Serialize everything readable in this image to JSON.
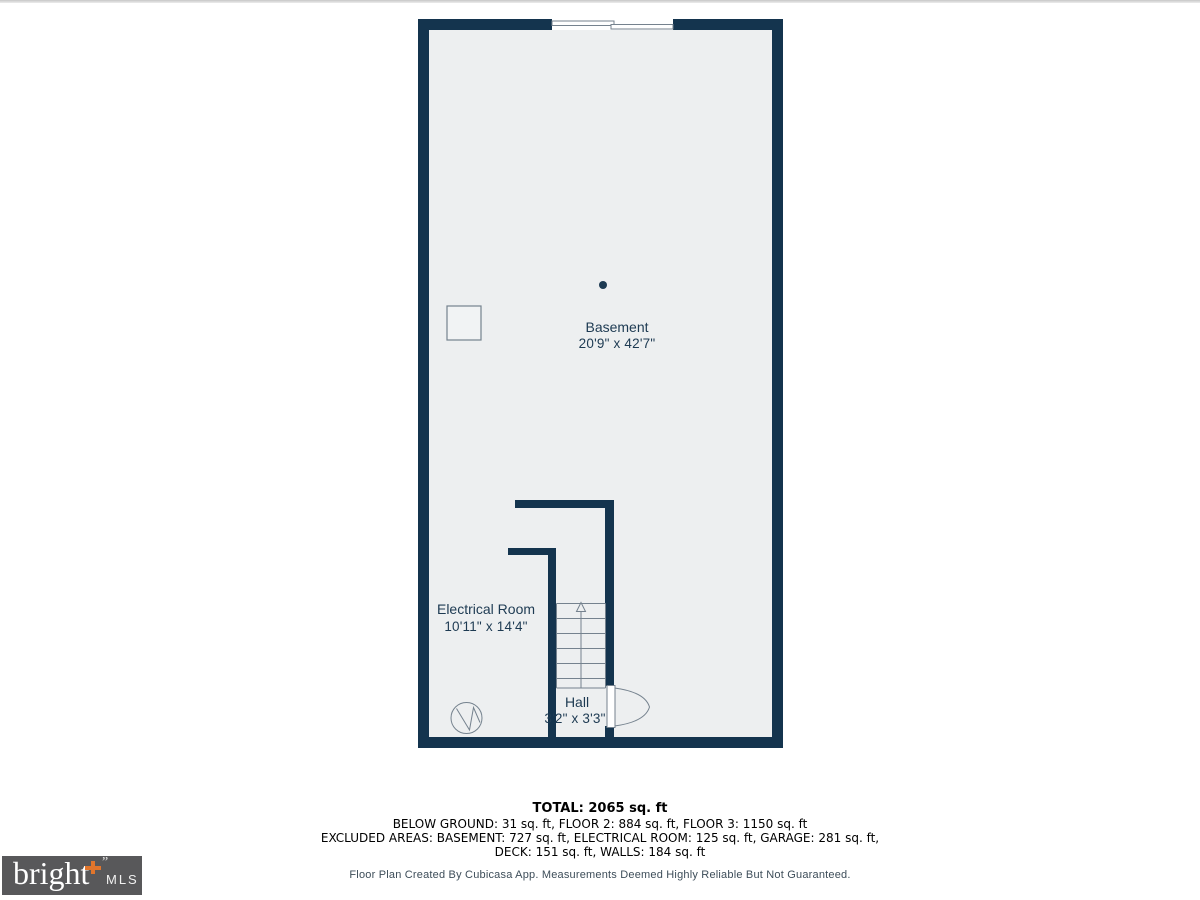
{
  "page": {
    "background": "#ffffff",
    "top_edge_line_color": "#c7c7c7"
  },
  "floorplan": {
    "colors": {
      "wall": "#14344e",
      "floor": "#edeff0",
      "line": "#75828e",
      "label": "#1d3a52",
      "white": "#ffffff"
    },
    "rooms": {
      "basement": {
        "name": "Basement",
        "dims": "20'9\" x 42'7\""
      },
      "electrical": {
        "name": "Electrical Room",
        "dims": "10'11\" x 14'4\""
      },
      "hall": {
        "name": "Hall",
        "dims": "3'2\" x 3'3\""
      }
    },
    "symbols": [
      "sliding-window-icon",
      "stairs-up-arrow-icon",
      "door-swing-icon",
      "column-icon",
      "water-heater-icon",
      "point-marker-icon"
    ]
  },
  "summary": {
    "total": "TOTAL: 2065 sq. ft",
    "line1": "BELOW GROUND: 31 sq. ft, FLOOR 2: 884 sq. ft, FLOOR 3: 1150 sq. ft",
    "line2": "EXCLUDED AREAS: BASEMENT: 727 sq. ft, ELECTRICAL ROOM: 125 sq. ft, GARAGE: 281 sq. ft,",
    "line3": "DECK: 151 sq. ft, WALLS: 184 sq. ft"
  },
  "footer": {
    "disclaimer": "Floor Plan Created By Cubicasa App. Measurements Deemed Highly Reliable But Not Guaranteed."
  },
  "logo": {
    "brand": "bright",
    "suffix": "MLS",
    "tm": "”",
    "background": "#58585a",
    "accent": "#e0752c",
    "text_color": "#ffffff"
  }
}
